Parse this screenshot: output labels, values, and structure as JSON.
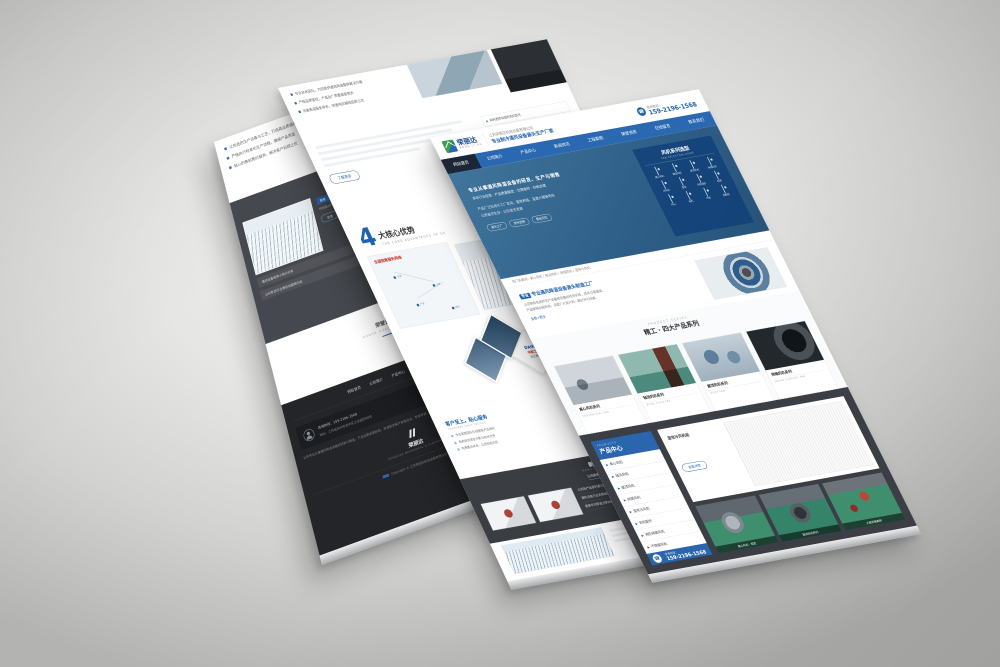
{
  "colors": {
    "accent_blue": "#2a66ad",
    "deep_blue": "#1f63ad",
    "banner_blue": "#2f6089",
    "dark_panel": "#3b3e44",
    "footer_dark": "#232528",
    "logo_green": "#3aa14a",
    "alert_red": "#c8342c"
  },
  "brand": {
    "logo_text": "荣丽达",
    "logo_sub": "RONG LI DA",
    "company": "江苏荣丽达机电设备有限公司",
    "tagline": "专业制冷通风设备源头生产厂家",
    "hotline_label": "咨询热线：",
    "phone": "159-2196-1568"
  },
  "front": {
    "nav_items": [
      "网站首页",
      "公司简介",
      "产品中心",
      "新闻资讯",
      "工程案例",
      "荣誉资质",
      "在线留言",
      "联系我们"
    ],
    "banner": {
      "line1": "专业从事通风降温设备的研发、生产与销售",
      "line2": "多年行业经验 · 产品质量稳定 · 交期准时 · 价格合理",
      "line3": "产品广泛应用于工厂车间、畜牧养殖、温室大棚等场所",
      "line4": "以质量求生存 · 以信誉求发展",
      "tags": [
        "源头工厂",
        "支持定制",
        "售后无忧"
      ],
      "panel_title": "风机系列选型",
      "panel_sub": "FAN SELECTION GUIDE",
      "grid": [
        "离心风机",
        "轴流风机",
        "屋顶风机",
        "排烟风机",
        "冷风机",
        "湿帘",
        "风机配件",
        "风阀",
        "风口",
        "电机",
        "叶轮",
        "控制柜"
      ]
    },
    "keywords": "热门关键词：离心风机 / 轴流风机 / 排烟风机 / 湿帘冷风机",
    "intro": {
      "tag": "专业通风降温设备源头制造工厂",
      "tag_em": "专业",
      "body1": "公司拥有先进的生产设备和完善的检测手段，技术力量雄厚，",
      "body2": "产品畅销全国各地，深受广大用户的一致好评与信赖。",
      "more": "查看+更多"
    },
    "section": {
      "en": "PRODUCT SERIES",
      "title": "精工 · 四大产品系列"
    },
    "cards": [
      {
        "name": "离心风机系列",
        "en": "CENTRIFUGAL FAN"
      },
      {
        "name": "轴流风机系列",
        "en": "AXIAL FLOW FAN"
      },
      {
        "name": "屋顶风机系列",
        "en": "ROOF FAN"
      },
      {
        "name": "排烟风机系列",
        "en": "SMOKE EXHAUST FAN"
      }
    ],
    "center": {
      "en": "PRODUCTS",
      "zh": "产品中心",
      "items": [
        "离心风机",
        "轴流风机",
        "屋顶风机",
        "排烟风机",
        "湿帘冷风机",
        "风机配件",
        "消防排烟风机",
        "不锈钢风机"
      ],
      "bullet": "▶",
      "main_caption": "湿帘冷风机组",
      "more_btn": "查看详情",
      "captions": [
        "离心风机 · 现货",
        "轴流风机系列",
        "工程安装案例"
      ]
    }
  },
  "middle": {
    "bullets": [
      "专业技术团队，为您提供通风降温整体解决方案",
      "严格品质管控，产品出厂质量层层把关",
      "完善售后服务体系，快速响应解除后顾之忧"
    ],
    "more_btn": "了解更多",
    "faq": [
      "如何选择合适的风机型号",
      "工业风机的日常维护保养",
      "排烟风机安装注意事项",
      "湿帘冷风机的使用技巧",
      "风机噪音大的解决办法",
      "离心风机与轴流风机的区别",
      "风机叶轮的清洗方法",
      "通风系统设计常见问题"
    ],
    "faq_bullet": "▶",
    "adv": {
      "num": "4",
      "title": "大核心优势",
      "sub": "THE CORE ADVANTAGES OF US"
    },
    "map_title": "全国销售服务网络",
    "map_dots": [
      "江苏",
      "山东",
      "广东",
      "四川"
    ],
    "adv1": {
      "title": "实力雄厚，专于行业前列",
      "sub": "STRENGTH LEADS THE INDUSTRY",
      "points": [
        "多年专注通风降温设备研发与制造",
        "厂房面积大，生产设备先进齐全",
        "产品通过多项质量体系认证"
      ]
    },
    "nums": [
      "01",
      "02",
      "03",
      "04"
    ],
    "partners": [
      "DAIKIN",
      "中航工业",
      "海立集团"
    ],
    "adv4": {
      "title": "客户至上，贴心服务",
      "sub": "CUSTOMER FIRST SERVICE",
      "points": [
        "专业客服团队在线解答产品疑问",
        "免费提供选型方案与技术支持",
        "完善售后体系，让您购买无忧"
      ]
    },
    "news": {
      "title": "新闻资讯",
      "sub": "NEWS INFORMATION",
      "tabs": [
        "公司新闻",
        "行业资讯"
      ],
      "more": "MORE+",
      "items": [
        {
          "t": "公司新产品顺利通过质量检测",
          "d": "2021-06-18"
        },
        {
          "t": "通风设备行业发展趋势分析",
          "d": "2021-06-10"
        },
        {
          "t": "夏季车间降温方案如何选择",
          "d": "2021-05-28"
        }
      ]
    }
  },
  "left": {
    "bullets": [
      "以先进的生产设备与工艺，打造高品质通风设备",
      "严格执行标准化生产流程，确保产品质量",
      "贴心的售前售后服务，解决客户后顾之忧"
    ],
    "news": {
      "en": "COMPANY NEWS",
      "title": "公司新闻",
      "tag": "聚焦",
      "item_title": "公司荣获行业优秀供应商称号",
      "item_body": "不断提升产品品质与服务水平，赢得了广大客户的认可与好评……",
      "view_btn": "查看",
      "list": [
        {
          "t": "通风设备保养小常识分享",
          "d": "06-12"
        },
        {
          "t": "公司参加行业博览会圆满归来",
          "d": "05-30"
        }
      ]
    },
    "mid_section": {
      "zh": "荣誉资质",
      "en": "HONOR QUALIFICATION"
    },
    "footer": {
      "links": [
        "网站首页",
        "公司简介",
        "产品中心",
        "新闻资讯",
        "联系我们"
      ],
      "contact_line1": "咨询热线：159-2196-1568",
      "contact_line2": "地址：江苏省苏州市吴中区工业园区88号",
      "mail_label": "在线留言",
      "about": "公司专业从事通风降温设备的研发与制造，产品远销全国各地，欢迎新老客户来电洽谈、参观考察，我们将竭诚为您服务。",
      "logo": "荣丽达",
      "logo_sub": "RONGLIDA MECHANICAL & ELECTRICAL",
      "copyright": "Copyright © 江苏荣丽达机电设备有限公司 版权所有"
    }
  }
}
